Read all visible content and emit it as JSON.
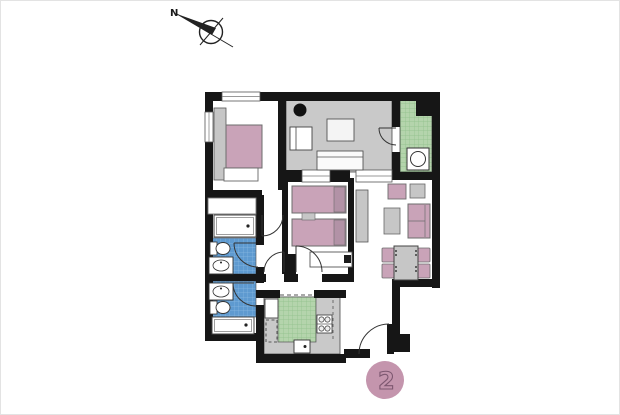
{
  "compass": {
    "label": "N"
  },
  "unit_badge": {
    "label": "2",
    "color": "#c495ad"
  },
  "palette": {
    "wall": "#161616",
    "terrace_floor": "#c9c9c9",
    "counter_gray": "#c9c9c9",
    "tile_green": "#b4d4ac",
    "tile_green_line": "#8fc08a",
    "tile_blue": "#5e9ad0",
    "tile_blue_line": "#88b8e2",
    "furniture_pink": "#c9a3b8",
    "pillow_pink": "#b292a6",
    "furniture_gray": "#c6c6c6",
    "fixture_white": "#ffffff"
  }
}
